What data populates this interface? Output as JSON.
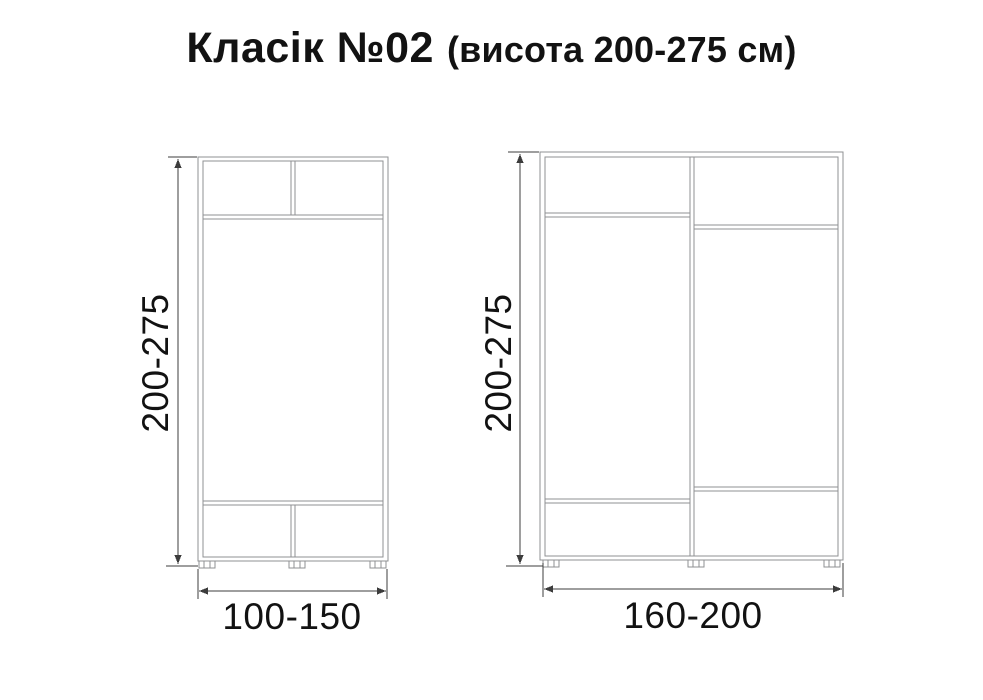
{
  "title": {
    "main": "Класік №02",
    "suffix": "(висота 200-275 см)"
  },
  "left_cabinet": {
    "height_label": "200-275",
    "width_label": "100-150"
  },
  "right_cabinet": {
    "height_label": "200-275",
    "width_label": "160-200"
  },
  "colors": {
    "background": "#ffffff",
    "cabinet_line": "#8f9193",
    "dimension_line": "#3c3c3c",
    "text": "#121212"
  }
}
